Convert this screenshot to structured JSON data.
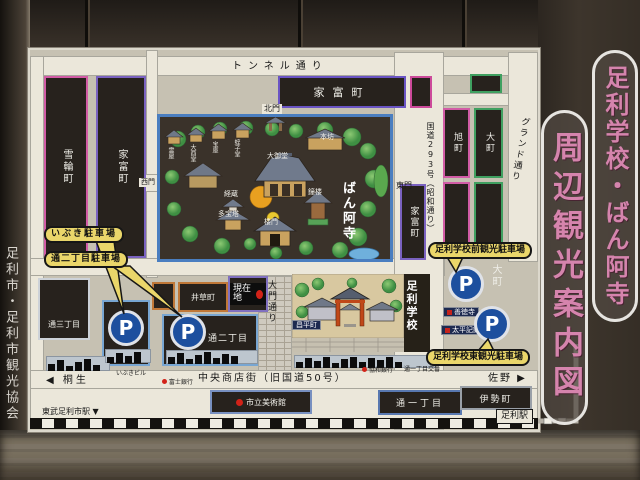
{
  "sign": {
    "publisher": "足利市・足利市観光協会",
    "title_main": "足利学校・ばん阿寺",
    "title_sub": "周辺観光案内図"
  },
  "streets": {
    "tunnel": "トンネル通り",
    "route293": "国道293号（昭和通り）",
    "grand": "グランド通り",
    "daimon": "大門通り",
    "chuo": "中央商店街（旧国道50号）"
  },
  "districts": {
    "yukiwa": "雪輪町",
    "yadomi_left": "家富町",
    "yadomi_top": "家富町",
    "yadomi_right": "家富町",
    "asahi": "旭町",
    "omachi": "大町",
    "omachi_east": "大町",
    "igusa": "井草町",
    "shohei": "昌平町",
    "tori3": "通三丁目",
    "tori2": "通二丁目",
    "tori1": "通一丁目",
    "ise": "伊勢町"
  },
  "temple": {
    "name": "ばん阿寺",
    "north_gate": "北門",
    "west_gate": "西門",
    "east_gate": "東門",
    "hombo": "本坊",
    "main_hall": "大御堂",
    "belfry": "鐘楼",
    "kyozo": "経蔵",
    "tahoto": "多宝塔",
    "romon": "楼門",
    "mitamaya": "霊屋",
    "otorido": "大酉堂",
    "hoko": "宝庫",
    "hirukodo": "蛭子堂"
  },
  "school": {
    "name": "足利学校"
  },
  "parking": {
    "symbol": "P",
    "ibuki": "いぶき駐車場",
    "tori2": "通二丁目駐車場",
    "front": "足利学校前観光駐車場",
    "east": "足利学校東観光駐車場"
  },
  "markers": {
    "current": "現在地",
    "museum": "市立美術館",
    "taiheiki": "太平記館",
    "zentokuji": "善徳寺",
    "fuji_bank": "富士銀行",
    "kyowa_bank": "協和銀行",
    "koban": "通一丁目交番",
    "ibuki_bldg": "いぶきビル"
  },
  "directions": {
    "kiryu": "◀ 桐生",
    "sano": "佐野 ▶",
    "tobu_station": "東武足利市駅 ▼",
    "jr_station": "足利駅"
  },
  "colors": {
    "title_pink": "#d584ad",
    "parking_blue": "#1d4f9e",
    "callout_yellow": "#ead66a",
    "current_red": "#d22218",
    "moat_blue": "#4a7ec0"
  }
}
